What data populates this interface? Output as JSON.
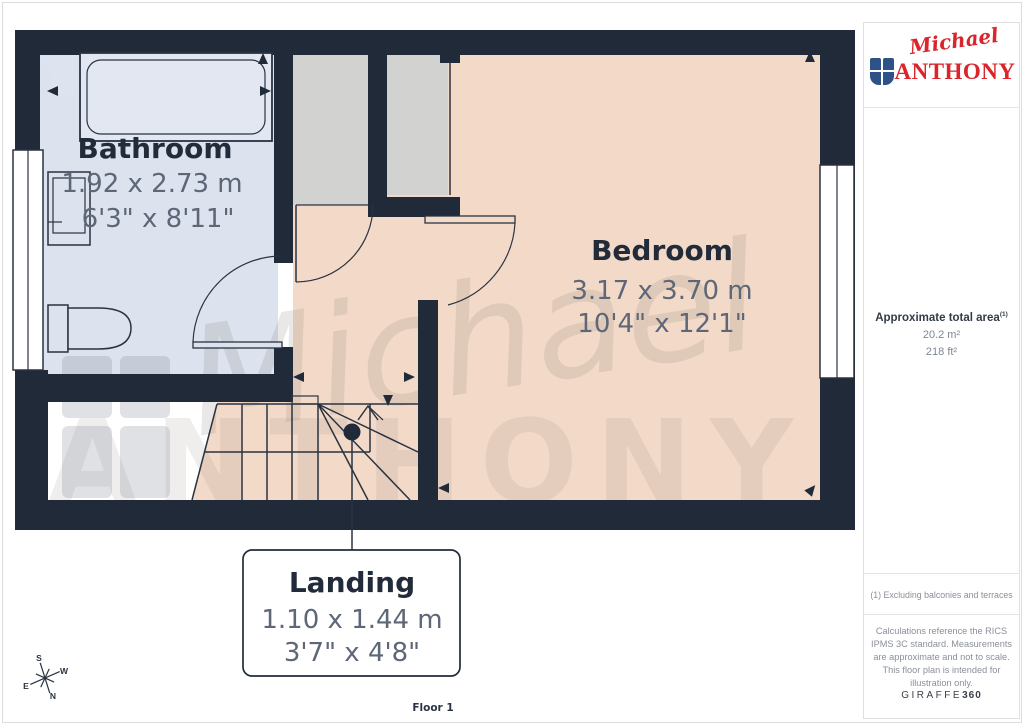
{
  "plan": {
    "rooms": {
      "bathroom": {
        "name": "Bathroom",
        "metric": "1.92 x 2.73 m",
        "imperial": "6'3\" x 8'11\""
      },
      "bedroom": {
        "name": "Bedroom",
        "metric": "3.17 x 3.70 m",
        "imperial": "10'4\" x 12'1\""
      },
      "landing": {
        "name": "Landing",
        "metric": "1.10 x 1.44 m",
        "imperial": "3'7\" x 4'8\""
      }
    },
    "floor_label": "Floor 1",
    "compass": {
      "n": "N",
      "s": "S",
      "e": "E",
      "w": "W"
    },
    "watermark": {
      "script": "Michael",
      "caps": "ANTHONY"
    }
  },
  "sidebar": {
    "logo": {
      "script": "Michael",
      "caps": "ANTHONY"
    },
    "area": {
      "label": "Approximate total area",
      "footnote_ref": "(1)",
      "metric": "20.2 m²",
      "imperial": "218 ft²"
    },
    "footnote": "(1) Excluding balconies and terraces",
    "disclaimer": "Calculations reference the RICS IPMS 3C standard. Measurements are approximate and not to scale. This floor plan is intended for illustration only.",
    "brand": {
      "name": "GIRAFFE",
      "suffix": "360"
    }
  },
  "colors": {
    "wall": "#212A38",
    "bathroom_floor": "#DCE2EE",
    "bedroom_floor": "#F3DAC8",
    "closet_floor": "#D2D2D0",
    "brand_red": "#D9252C",
    "shield_blue": "#2E5288"
  }
}
